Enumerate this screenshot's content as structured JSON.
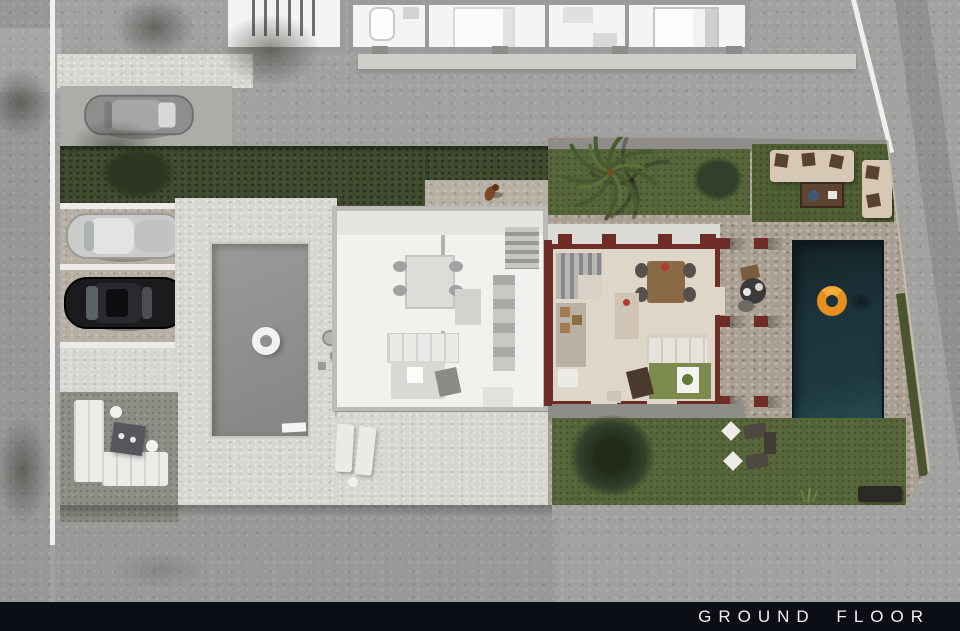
{
  "footer": {
    "label": "GROUND FLOOR"
  },
  "colors": {
    "footer_bg": "#0c0e15",
    "footer_text": "#f0f0f0",
    "asphalt": "#a1a1a0",
    "curb": "#f0efec",
    "paving_light": "#d8d6d1",
    "stone": "#a99f92",
    "lawn": "#57663a",
    "lawn_dark": "#4f5e33",
    "hedge": "#414b2f",
    "tree": "#31402a",
    "pool_water": "#1d3840",
    "pool_gray": "#8f8f8d",
    "float_orange": "#e5901f",
    "ring_white": "#f1f1ef",
    "wall_maroon": "#6e2d26",
    "floor_beige": "#ded6c9",
    "floor_gray": "#f2f1ee",
    "rug_olive": "#7d8a4e",
    "wood": "#8a6a45",
    "sofa_beige": "#d7c8b6",
    "pillow_brown": "#59422f",
    "car_silver": "#cbcbc9",
    "car_black": "#1b1b1e",
    "car_gray": "#8e8e8c",
    "neighbor_wall": "#9b9b9b",
    "neighbor_floor": "#f4f4f2"
  }
}
